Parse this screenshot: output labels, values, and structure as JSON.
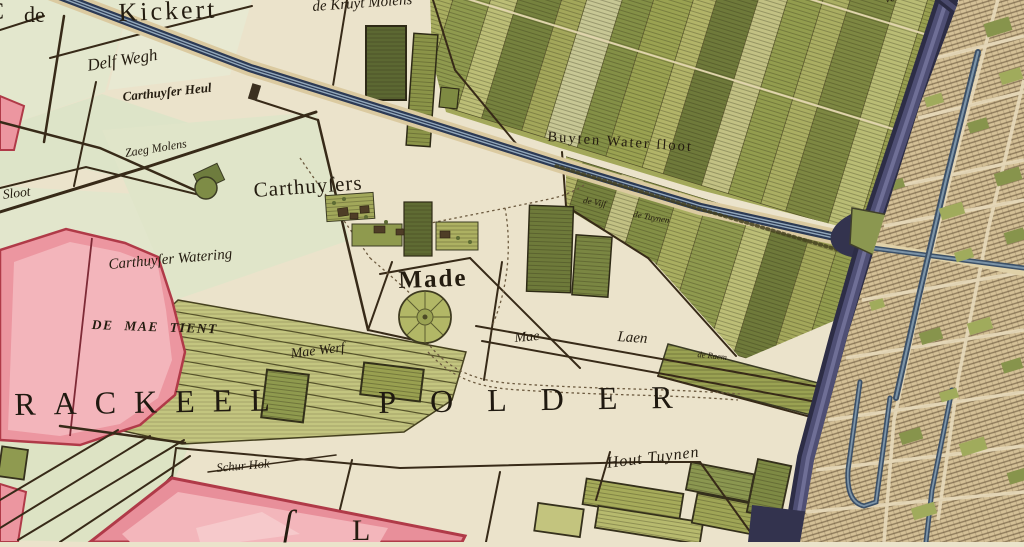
{
  "map_type": "antique-polder-map",
  "labels": {
    "de_article": "de",
    "kickert": "Kickert",
    "kruyt_molens": "de Kruyt Molens",
    "delf_wegh": "Delf Wegh",
    "carthuyser_heul": "Carthuyſer Heul",
    "zaeg_molens": "Zaeg Molens",
    "sloot": "Sloot",
    "buyten_watersloot": "Buyten Water ſloot",
    "carthuysers": "Carthuyſers",
    "de_vijf": "de Vijf",
    "de_tuynen": "de Tuynen",
    "carthuyser_watering": "Carthuyſer Watering",
    "de_mae_tient": "DE MAE TIENT",
    "made": "Made",
    "mae_werf": "Mae Werf",
    "mae": "Mae",
    "laen": "Laen",
    "de_raem": "de Raem",
    "rackeel": "RACKEEL",
    "polder": "POLDER",
    "schur_hok": "Schur Hok",
    "hout_tuynen": "Hout Tuynen",
    "vest": "vest",
    "partial_letter_s": "ſ",
    "partial_letter_l": "L",
    "partial_letter_c": "C"
  },
  "palette": {
    "parchment": "#ebe3cb",
    "field_green": "#dfe5c9",
    "garden_olive": "#a3a85a",
    "garden_dark": "#6f7a3a",
    "strip_yellow_green": "#c3c57f",
    "highlight_pink": "#ec96a0",
    "pink_border": "#b03a48",
    "canal_light": "#94a9bb",
    "canal_dark": "#2e3c58",
    "moat_dark": "#38385a",
    "city_tan": "#d4c096",
    "ink_brown": "#372a18",
    "text_ink": "#241c10"
  }
}
